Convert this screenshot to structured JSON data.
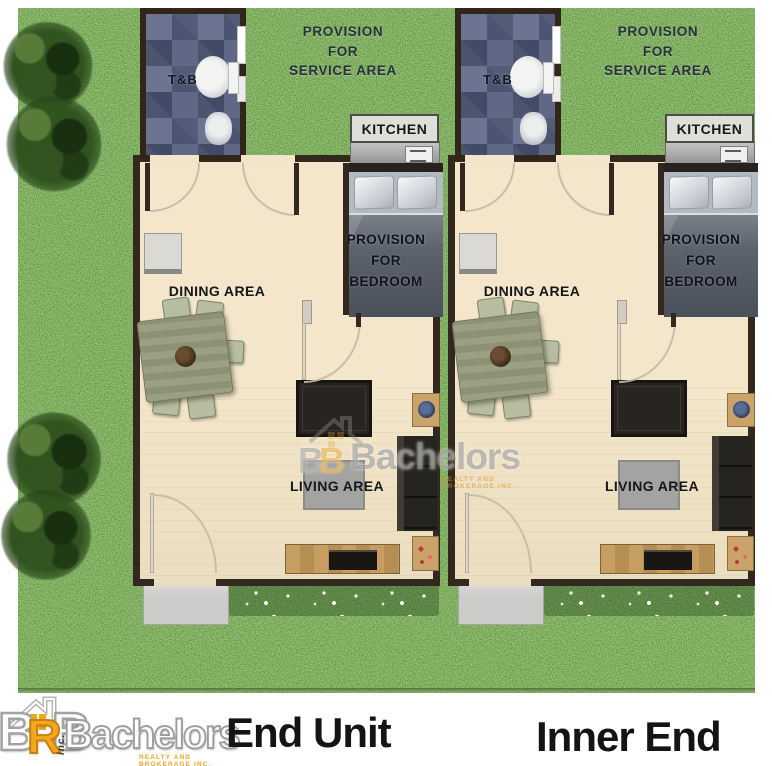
{
  "units": [
    {
      "label": "End Unit",
      "rooms": {
        "tnb": "T&B",
        "service_area": "PROVISION\nFOR\nSERVICE AREA",
        "kitchen": "KITCHEN",
        "bedroom": "PROVISION\nFOR\nBEDROOM",
        "dining": "DINING AREA",
        "living": "LIVING AREA"
      }
    },
    {
      "label": "Inner End",
      "rooms": {
        "tnb": "T&B",
        "service_area": "PROVISION\nFOR\nSERVICE AREA",
        "kitchen": "KITCHEN",
        "bedroom": "PROVISION\nFOR\nBEDROOM",
        "dining": "DINING AREA",
        "living": "LIVING AREA"
      }
    }
  ],
  "watermark": {
    "letters": [
      "B",
      "B"
    ],
    "name": "Bachelors",
    "tagline": "REALTY AND BROKERAGE INC."
  },
  "footer": {
    "brand": {
      "letters": [
        "B",
        "R",
        "B"
      ],
      "inc": "inc.",
      "name": "Bachelors",
      "tagline": "REALTY AND BROKERAGE INC."
    }
  },
  "colors": {
    "grass": "#49742f",
    "floor": "#f2e5c9",
    "wall": "#33281d",
    "tile": "#5f6884",
    "accent_yellow": "#f2a71f"
  }
}
